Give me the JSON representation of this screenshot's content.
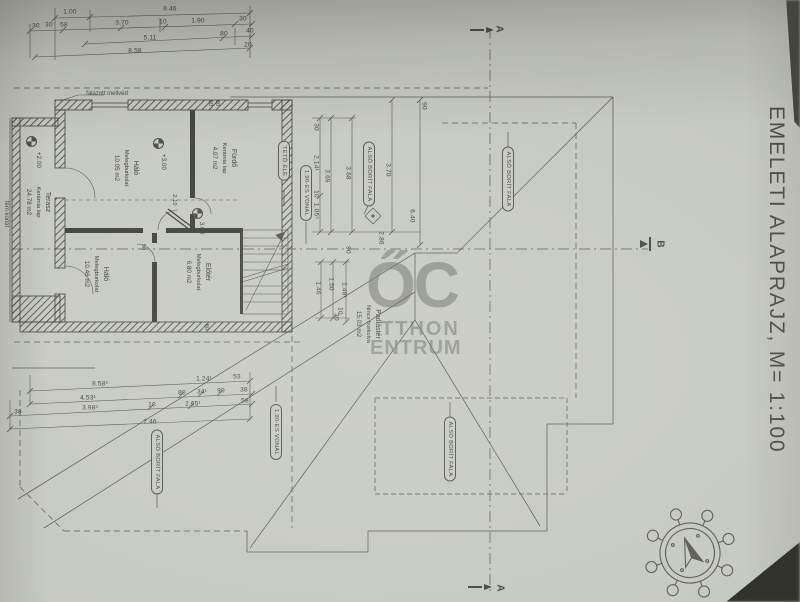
{
  "title": {
    "text": "EMELETI ALAPRAJZ, M= 1:100"
  },
  "watermark": {
    "big": "ŐC",
    "line1": "TTHON",
    "line2": "ENTRUM"
  },
  "section_markers": [
    {
      "label": "A",
      "x": 499,
      "y": 29
    },
    {
      "label": "A",
      "x": 500,
      "y": 588
    },
    {
      "label": "B",
      "x": 660,
      "y": 244
    }
  ],
  "rooms": [
    {
      "name": "Terasz",
      "finish": "Kerámia lap",
      "area": "24.78 m2",
      "x": 38,
      "y": 202
    },
    {
      "name": "Háló",
      "finish": "Melegburkolat",
      "area": "10.05 m2",
      "x": 126,
      "y": 168
    },
    {
      "name": "Fürdő",
      "finish": "Kerámia lap",
      "area": "4.07 m2",
      "x": 224,
      "y": 158
    },
    {
      "name": "Háló",
      "finish": "Melegburkolat",
      "area": "10.46 m2",
      "x": 96,
      "y": 274
    },
    {
      "name": "Előtér",
      "finish": "Melegburkolat",
      "area": "6.80 m2",
      "x": 198,
      "y": 272
    },
    {
      "name": "Padlástér",
      "finish": "Nincs burkolva",
      "area": "15.03 m2",
      "x": 368,
      "y": 324
    }
  ],
  "levels": [
    {
      "t": "+2.00",
      "ix": 26,
      "iy": 136,
      "tx": 38,
      "ty": 160
    },
    {
      "t": "+3.00",
      "ix": 153,
      "iy": 138,
      "tx": 163,
      "ty": 162
    },
    {
      "t": "3.00",
      "ix": 192,
      "iy": 208,
      "tx": 201,
      "ty": 228
    }
  ],
  "notes": [
    {
      "t": "falazott mellvéd",
      "x": 107,
      "y": 94,
      "r": 0
    },
    {
      "t": "fém korlát",
      "x": 6,
      "y": 214,
      "r": 90
    }
  ],
  "capsules": [
    {
      "t": "TETŐ ÉLE",
      "x": 284,
      "y": 161
    },
    {
      "t": "1.90-ES VONAL",
      "x": 306,
      "y": 193
    },
    {
      "t": "ALSÓ BORÍT FALA",
      "x": 369,
      "y": 174
    },
    {
      "t": "ALSÓ BORÍT FALA",
      "x": 508,
      "y": 179
    },
    {
      "t": "1.90-ES VONAL",
      "x": 276,
      "y": 432
    },
    {
      "t": "ALSÓ BORÍT FALA",
      "x": 450,
      "y": 449
    },
    {
      "t": "ALSÓ BORÍT FALA",
      "x": 157,
      "y": 462
    }
  ],
  "dims": [
    {
      "t": "1.00",
      "x": 70,
      "y": 12
    },
    {
      "t": "8.46",
      "x": 170,
      "y": 9
    },
    {
      "t": "30",
      "x": 36,
      "y": 26
    },
    {
      "t": "30",
      "x": 49,
      "y": 25
    },
    {
      "t": "58",
      "x": 64,
      "y": 25
    },
    {
      "t": "3.70",
      "x": 122,
      "y": 23
    },
    {
      "t": "10",
      "x": 163,
      "y": 22
    },
    {
      "t": "1.90",
      "x": 198,
      "y": 21
    },
    {
      "t": "30",
      "x": 243,
      "y": 19
    },
    {
      "t": "5.11",
      "x": 150,
      "y": 38
    },
    {
      "t": "80",
      "x": 224,
      "y": 34
    },
    {
      "t": "40",
      "x": 250,
      "y": 31
    },
    {
      "t": "8.58",
      "x": 135,
      "y": 51
    },
    {
      "t": "20",
      "x": 248,
      "y": 45
    },
    {
      "t": "8.58³",
      "x": 100,
      "y": 384
    },
    {
      "t": "1.24¹",
      "x": 204,
      "y": 379
    },
    {
      "t": "53",
      "x": 237,
      "y": 377
    },
    {
      "t": "4.53¹",
      "x": 88,
      "y": 398
    },
    {
      "t": "80",
      "x": 182,
      "y": 393
    },
    {
      "t": "34¹",
      "x": 202,
      "y": 392
    },
    {
      "t": "90",
      "x": 221,
      "y": 391
    },
    {
      "t": "38",
      "x": 244,
      "y": 390
    },
    {
      "t": "38",
      "x": 18,
      "y": 412
    },
    {
      "t": "3.98³",
      "x": 90,
      "y": 408
    },
    {
      "t": "10",
      "x": 152,
      "y": 405
    },
    {
      "t": "2.65¹",
      "x": 193,
      "y": 404
    },
    {
      "t": "58",
      "x": 245,
      "y": 401
    },
    {
      "t": "7.46",
      "x": 150,
      "y": 422
    },
    {
      "t": "30",
      "x": 316,
      "y": 127,
      "r": 90
    },
    {
      "t": "2.14¹",
      "x": 316,
      "y": 163,
      "r": 90
    },
    {
      "t": "10",
      "x": 316,
      "y": 194,
      "r": 90
    },
    {
      "t": "1.05⁵",
      "x": 316,
      "y": 211,
      "r": 90
    },
    {
      "t": "3.69",
      "x": 327,
      "y": 176,
      "r": 90
    },
    {
      "t": "3.68",
      "x": 348,
      "y": 173,
      "r": 90
    },
    {
      "t": "3.70",
      "x": 388,
      "y": 170,
      "r": 90
    },
    {
      "t": "90",
      "x": 424,
      "y": 106,
      "r": 90
    },
    {
      "t": "6.40",
      "x": 412,
      "y": 216,
      "r": 90
    },
    {
      "t": "2.86",
      "x": 381,
      "y": 238,
      "r": 90
    },
    {
      "t": "90",
      "x": 348,
      "y": 250,
      "r": 90
    },
    {
      "t": "1.46",
      "x": 318,
      "y": 288,
      "r": 90
    },
    {
      "t": "1.50",
      "x": 331,
      "y": 284,
      "r": 90
    },
    {
      "t": "1.48¹",
      "x": 344,
      "y": 290,
      "r": 90
    },
    {
      "t": "10",
      "x": 340,
      "y": 311,
      "r": 90
    },
    {
      "t": "30",
      "x": 336,
      "y": 317,
      "r": 90
    },
    {
      "t": "80",
      "x": 210,
      "y": 103,
      "r": 90,
      "s": 5.5
    },
    {
      "t": "80",
      "x": 217,
      "y": 103,
      "r": 90,
      "s": 5.5
    },
    {
      "t": "2.10",
      "x": 174,
      "y": 200,
      "r": 90,
      "s": 5.5
    },
    {
      "t": "90",
      "x": 143,
      "y": 247,
      "r": 90,
      "s": 5.5
    },
    {
      "t": "80",
      "x": 206,
      "y": 327,
      "r": 90,
      "s": 5.5
    }
  ]
}
